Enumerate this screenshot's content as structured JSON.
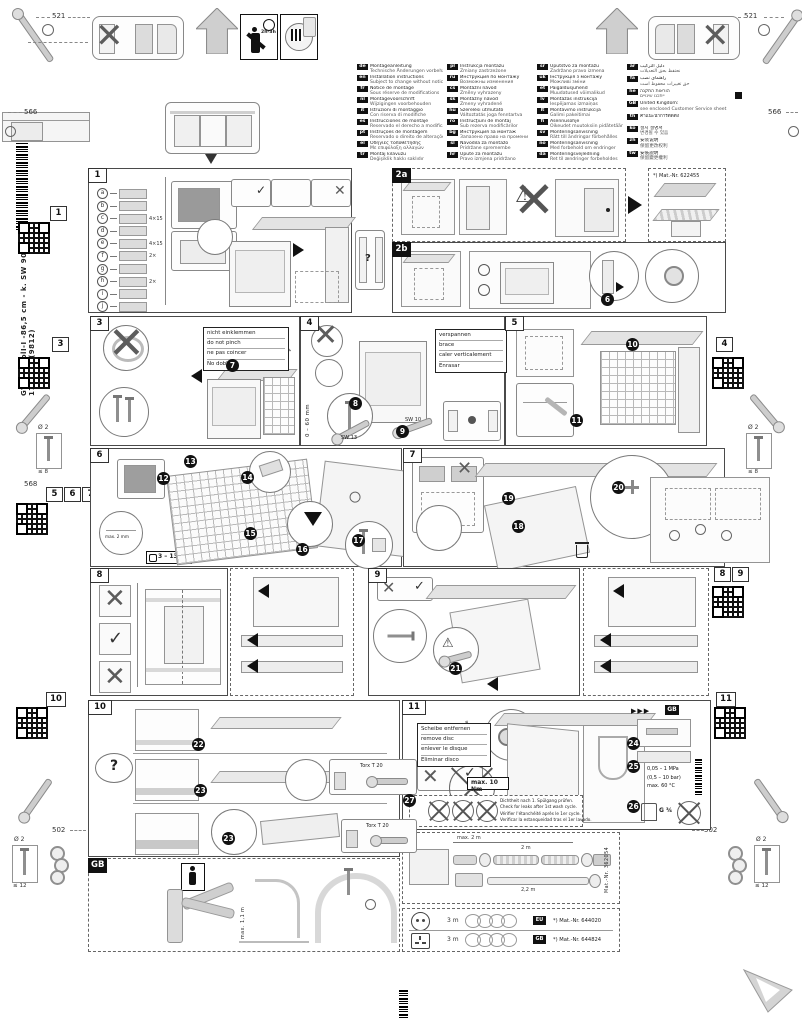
{
  "colors": {
    "ink": "#1a1a1a",
    "line": "#8c8c8c",
    "fill": "#ececec",
    "panel_border": "#4a4a4a",
    "step_bg": "#111111"
  },
  "sidebar": {
    "code_line": "GV 640VolI-I -86,5 cm - k. SW    9001 170 324 (9812)"
  },
  "dims": {
    "d521": "521",
    "d566": "566",
    "d568": "568",
    "d502": "502",
    "screw_dia": "Ø 2",
    "depth8": "≤ 8",
    "depth12": "≤ 12",
    "time": "2h-3h"
  },
  "glyphs": {
    "cross": "✕",
    "check": "✓",
    "warn": "⚠",
    "q": "?",
    "arrow_r": "►",
    "arrows": "▶▶▶"
  },
  "tabs": {
    "t1": "1",
    "t2a": "2a",
    "t2b": "2b",
    "t3": "3",
    "t4": "4",
    "t5": "5",
    "t6": "6",
    "t7": "7",
    "t8": "8",
    "t9": "9",
    "t10": "10",
    "t11": "11",
    "tgb": "GB"
  },
  "header": {
    "columns": [
      [
        {
          "code": "de",
          "l1": "Montageanleitung",
          "l2": "Technische Änderungen vorbehalten"
        },
        {
          "code": "en",
          "l1": "Installation instructions",
          "l2": "Subject to change without notice"
        },
        {
          "code": "fr",
          "l1": "Notice de montage",
          "l2": "Sous réserve de modifications"
        },
        {
          "code": "nl",
          "l1": "Montagevoorschrift",
          "l2": "Wijzigingen voorbehouden"
        },
        {
          "code": "it",
          "l1": "Istruzioni di montaggio",
          "l2": "Con riserva di modifiche"
        },
        {
          "code": "es",
          "l1": "Instrucciones de montaje",
          "l2": "Reservado el derecho a modificaciones"
        },
        {
          "code": "pt",
          "l1": "Instruções de montagem",
          "l2": "Reservado o direito de alterações"
        },
        {
          "code": "el",
          "l1": "Οδηγίες τοποθέτησης",
          "l2": "Με επιφύλαξη αλλαγών"
        },
        {
          "code": "tr",
          "l1": "Montaj kılavuzu",
          "l2": "Değişiklik hakkı saklıdır"
        }
      ],
      [
        {
          "code": "pl",
          "l1": "Instrukcja montażu",
          "l2": "Zmiany zastrzeżone"
        },
        {
          "code": "ru",
          "l1": "Инструкция по монтажу",
          "l2": "Возможны изменения"
        },
        {
          "code": "cs",
          "l1": "Montážní návod",
          "l2": "Změny vyhrazeny"
        },
        {
          "code": "sk",
          "l1": "Montážny návod",
          "l2": "Zmeny vyhradené"
        },
        {
          "code": "hu",
          "l1": "Szerelési útmutató",
          "l2": "Változtatás joga fenntartva"
        },
        {
          "code": "ro",
          "l1": "Instrucţiuni de montaj",
          "l2": "Sub rezerva modificărilor"
        },
        {
          "code": "bg",
          "l1": "Инструкция за монтаж",
          "l2": "Запазено право на промени"
        },
        {
          "code": "sl",
          "l1": "Navodila za montažo",
          "l2": "Pridržane spremembe"
        },
        {
          "code": "hr",
          "l1": "Upute za montažu",
          "l2": "Pravo izmjena pridržano"
        }
      ],
      [
        {
          "code": "sr",
          "l1": "Uputstvo za montažu",
          "l2": "Zadržano pravo izmena"
        },
        {
          "code": "uk",
          "l1": "Інструкція з монтажу",
          "l2": "Можливі зміни"
        },
        {
          "code": "et",
          "l1": "Paigaldusjuhend",
          "l2": "Muudatused võimalikud"
        },
        {
          "code": "lv",
          "l1": "Montāžas instrukcija",
          "l2": "Iespējamas izmaiņas"
        },
        {
          "code": "lt",
          "l1": "Montavimo instrukcija",
          "l2": "Galimi pakeitimai"
        },
        {
          "code": "fi",
          "l1": "Asennusohje",
          "l2": "Oikeudet muutoksiin pidätetään"
        },
        {
          "code": "sv",
          "l1": "Monteringsanvisning",
          "l2": "Rätt till ändringar förbehålles"
        },
        {
          "code": "no",
          "l1": "Monteringsanvisning",
          "l2": "Med forbehold om endringer"
        },
        {
          "code": "da",
          "l1": "Monteringsvejledning",
          "l2": "Ret til ændringer forbeholdes"
        }
      ],
      [
        {
          "code": "ar",
          "l1": "دليل التركيب",
          "l2": "نحتفظ بحق التعديلات"
        },
        {
          "code": "fa",
          "l1": "راهنمای نصب",
          "l2": "حق تغییرات محفوظ است"
        },
        {
          "code": "he",
          "l1": "הוראות התקנה",
          "l2": "ייתכנו שינויים"
        },
        {
          "code": "GB",
          "l1": "United Kingdom:",
          "l2": "see enclosed Customer Service sheet"
        },
        {
          "code": "th",
          "l1": "คำแนะนำการติดตั้ง",
          "l2": ""
        },
        {
          "code": "ko",
          "l1": "설치 설명서",
          "l2": "변경될 수 있음"
        },
        {
          "code": "zh",
          "l1": "安装说明",
          "l2": "保留更改权利"
        },
        {
          "code": "tw",
          "l1": "安裝說明",
          "l2": "保留變更權利"
        }
      ]
    ]
  },
  "p1": {
    "parts": [
      {
        "letter": "a",
        "qty": ""
      },
      {
        "letter": "b",
        "qty": ""
      },
      {
        "letter": "c",
        "qty": "4×15"
      },
      {
        "letter": "d",
        "qty": ""
      },
      {
        "letter": "e",
        "qty": "4×15"
      },
      {
        "letter": "f",
        "qty": "2×"
      },
      {
        "letter": "g",
        "qty": ""
      },
      {
        "letter": "h",
        "qty": "2×"
      },
      {
        "letter": "i",
        "qty": ""
      },
      {
        "letter": "j",
        "qty": ""
      }
    ]
  },
  "p2a": {
    "mat": "*) Mat.-Nr. 622455"
  },
  "p3": {
    "note": {
      "l1": "nicht einklemmen",
      "l2": "do not pinch",
      "l3": "ne pas coincer",
      "l4": "No doblar"
    }
  },
  "p4": {
    "note": {
      "l1": "verspannen",
      "l2": "brace",
      "l3": "caler verticalement",
      "l4": "Enrasar"
    },
    "sw13": "SW 13",
    "sw10": "SW 10",
    "range": "0 – 60 mm"
  },
  "p6": {
    "weight": "3 – 13 kg",
    "gap": "max. 2 mm"
  },
  "p10": {
    "torx1": "Torx T 20",
    "torx2": "Torx T 20"
  },
  "p11": {
    "note": {
      "l1": "Scheibe entfernen",
      "l2": "remove disc",
      "l3": "enlever le disque",
      "l4": "Eliminar disco"
    },
    "torque": "max. 10 Nm",
    "min_dia": "min. Ø 34 mm",
    "gb_ref": "GB",
    "leak": {
      "l1": "Dichtheit nach 1. Spülgang prüfen.",
      "l2": "Check for leaks after 1st wash cycle.",
      "l3": "Vérifier l'étanchéité après le 1er cycle.",
      "l4": "Verificar la estanqueidad tras el 1er lavado."
    },
    "pressure": {
      "l1": "0,05 – 1 MPa",
      "l2": "(0,5 – 10 bar)",
      "l3": "max. 60 °C"
    },
    "thread": "G ¾"
  },
  "gb_panel": {
    "max_len": "max. 1,1 m"
  },
  "hose": {
    "dim_top": "max. 2 m",
    "dim_mid": "2 m",
    "dim_bot": "2,2 m",
    "mat": "Mat.-Nr. 362054"
  },
  "cords": [
    {
      "len": "3 m",
      "badge": "EU",
      "mat": "*) Mat.-Nr. 644020"
    },
    {
      "len": "3 m",
      "badge": "GB",
      "mat": "*) Mat.-Nr. 644824"
    }
  ],
  "steps": {
    "s1": "1",
    "s2": "2",
    "s3": "3",
    "s4": "4",
    "s5": "5",
    "s6": "6",
    "s7": "7",
    "s8": "8",
    "s9": "9",
    "s10": "10",
    "s11": "11",
    "s12": "12",
    "s13": "13",
    "s14": "14",
    "s15": "15",
    "s16": "16",
    "s17": "17",
    "s18": "18",
    "s19": "19",
    "s20": "20",
    "s21": "21",
    "s22": "22",
    "s23": "23",
    "s24": "24",
    "s25": "25",
    "s26": "26",
    "s27": "27"
  }
}
